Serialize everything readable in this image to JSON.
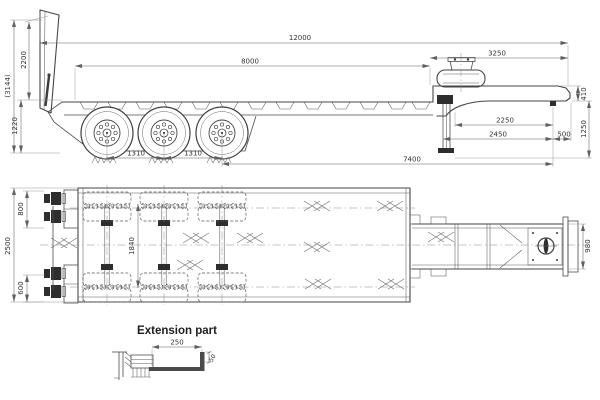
{
  "side": {
    "overall_length": "12000",
    "deck_length": "8000",
    "gooseneck_length": "3250",
    "overall_height": "(3144)",
    "ramp_height": "2200",
    "deck_height": "1220",
    "axle_spacing_a": "1310",
    "axle_spacing_b": "1310",
    "neck_depth": "410",
    "neck_to_kingpin": "2250",
    "leg_to_kingpin": "2450",
    "rear_overhang": "500",
    "kingpin_height": "1250",
    "axle_to_kingpin": "7400"
  },
  "plan": {
    "overall_width": "2500",
    "top_hinge_width": "800",
    "bottom_hinge_width": "600",
    "inner_width": "1840",
    "neck_width": "980"
  },
  "extension": {
    "title": "Extension part",
    "length": "250",
    "thickness": "50"
  }
}
